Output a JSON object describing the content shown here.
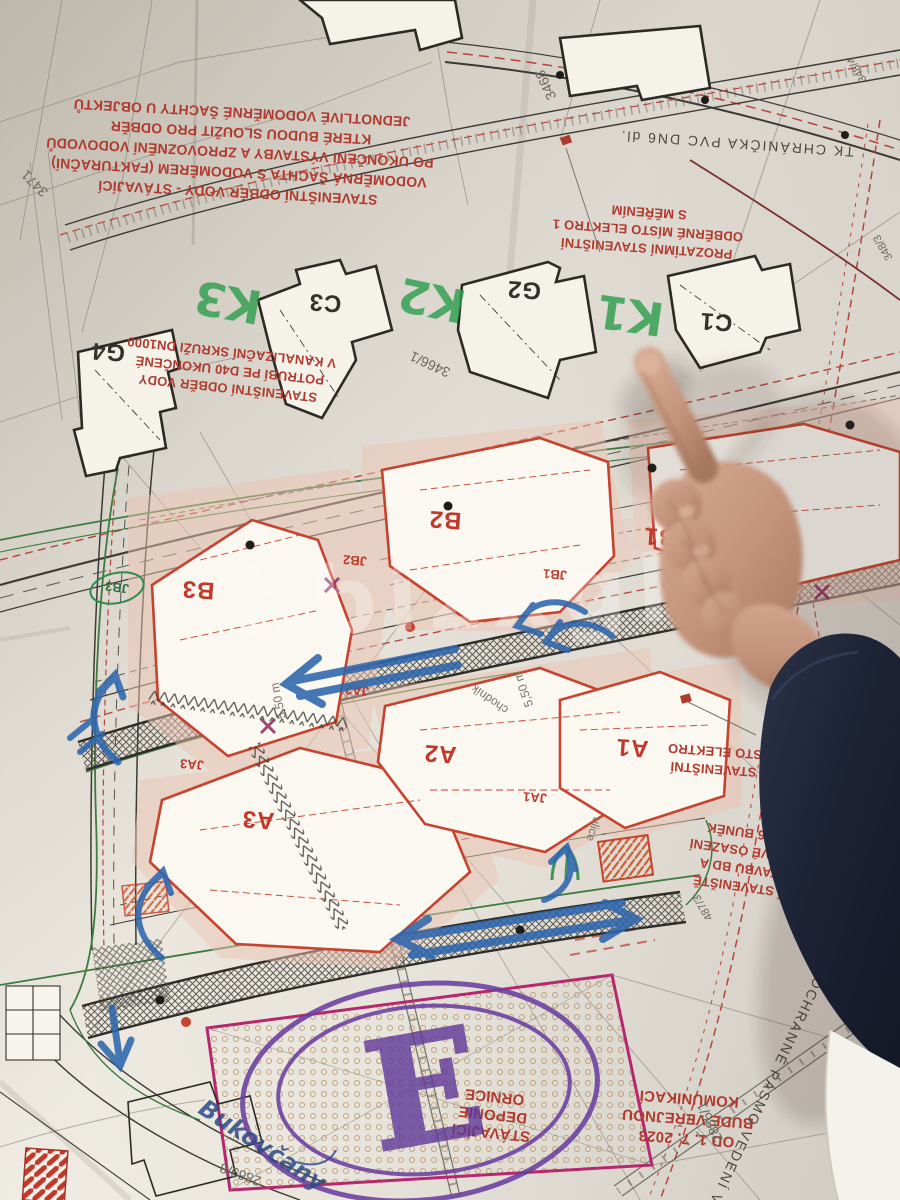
{
  "colors": {
    "paper": "#ebe7de",
    "red_note": "#b03a2e",
    "building_red": "#c6432e",
    "line_black": "#3a3833",
    "green_line": "#3d7a3f",
    "green_pen": "#2f9e4f",
    "blue_pen": "#2e66ad",
    "purple_pen": "#6a3fa0",
    "magenta": "#b5286d",
    "sleeve": "#1f2637",
    "skin": "#c79a85"
  },
  "plan": {
    "building_labels": {
      "g4": "G4",
      "c3": "C3",
      "g2": "G2",
      "c1": "C1",
      "b1": "B1",
      "b2": "B2",
      "b3": "B3",
      "jb1": "JB1",
      "jb2": "JB2",
      "jb3": "JB3",
      "a1": "A1",
      "a2": "A2",
      "a3": "A3",
      "ja1": "JA1",
      "ja2": "JA2",
      "ja3": "JA3"
    },
    "notes": {
      "water_shaft": {
        "l1": "STAVENIŠTNÍ ODBĚR VODY - STÁVAJÍCÍ",
        "l2": "VODOMĚRNÁ ŠACHTA S VODOMĚREM (FAKTURAČNÍ)",
        "l3": "PO UKONČENÍ VÝSTAVBY A ZPROVOZNĚNÍ VODOVODŮ",
        "l4": "KTERÉ BUDOU SLOUŽIT PRO ODBĚR",
        "l5": "JEDNOTLIVÉ VODOMĚRNÉ ŠACHTY U OBJEKTŮ"
      },
      "water_pipe": {
        "l1": "STAVENIŠTNÍ ODBĚR VODY",
        "l2": "POTRUBÍ PE D40 UKONČENÉ",
        "l3": "V KANALIZAČNÍ SKRUŽI DN1000"
      },
      "elektro_top": {
        "l1": "PROZATÍMNÍ STAVENIŠTNÍ",
        "l2": "ODBĚRNÉ MÍSTO ELEKTRO 1",
        "l3": "S MĚŘENÍM"
      },
      "elektro_side": {
        "l1": "PROZATÍMNÍ STAVENIŠTNÍ",
        "l2": "ODBĚRNÉ MÍSTO ELEKTRO"
      },
      "site_facilities": {
        "l1": "ZAŘÍZENÍ STAVENIŠTĚ",
        "l2": "PRO VÝSTAVBU BD A",
        "l3": "DVOUPATROVÉ OSAZENÍ",
        "l4": "CELKEM 6+6 BUNĚK"
      },
      "deponie": {
        "l1": "STÁVAJÍCÍ",
        "l2": "DEPONIE",
        "l3": "ORNICE"
      },
      "public_road": {
        "l1": "OD 1. 7. 2023",
        "l2": "BUDE VEŘEJNOU",
        "l3": "KOMUNIKACÍ"
      },
      "vvn": "OCHRANNÉ PÁSMO VEDENÍ VVN",
      "tk": "TK CHRÁNIČKA PVC DN6 dl."
    },
    "parcels": {
      "p1": "3471",
      "p2": "3468",
      "p3": "3466/1",
      "p4": "2886/1",
      "p5": "2869/8",
      "p6": "487/3",
      "p7": "348/4",
      "p8": "348/3"
    },
    "annotations": {
      "d1": "5,50 m",
      "d2": "5,50 m",
      "chodnik": "chodník",
      "ulice": "ulice"
    }
  },
  "handwriting": {
    "k1": "K1",
    "k2": "K2",
    "k3": "K3",
    "big_e": "E",
    "blue_note": "Bukovčany"
  },
  "watermark": {
    "text": "hbizxgl"
  }
}
